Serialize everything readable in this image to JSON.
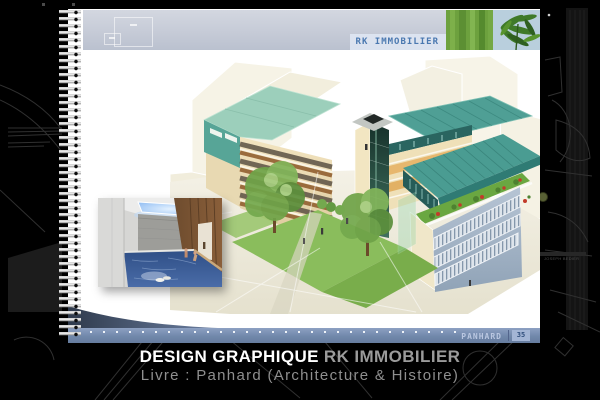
{
  "page": {
    "header": {
      "brand": "RK IMMOBILIER"
    },
    "footer_bar": {
      "project": "PANHARD",
      "page_number": "35"
    },
    "images": {
      "main": "3d-building-rendering",
      "inset": "indoor-pool-rendering",
      "plant": "green-plant-photo"
    }
  },
  "caption": {
    "title_white": "DESIGN GRAPHIQUE",
    "title_gray": "RK IMMOBILIER",
    "subtitle": "Livre : Panhard (Architecture & Histoire)"
  },
  "background": {
    "street_label": "JOSEPH BEDIER"
  },
  "colors": {
    "accent_blue": "#4a78b0",
    "footer_blue": "#7a8fb5",
    "roof_teal": "#4a9c92",
    "roof_seafoam": "#9ccfbb",
    "facade_cream": "#eee0b8",
    "facade_bluegray": "#a7b8ca",
    "grass_green": "#8abd5c",
    "pool_blue": "#3b5c96",
    "plant_green": "#6da13e"
  }
}
